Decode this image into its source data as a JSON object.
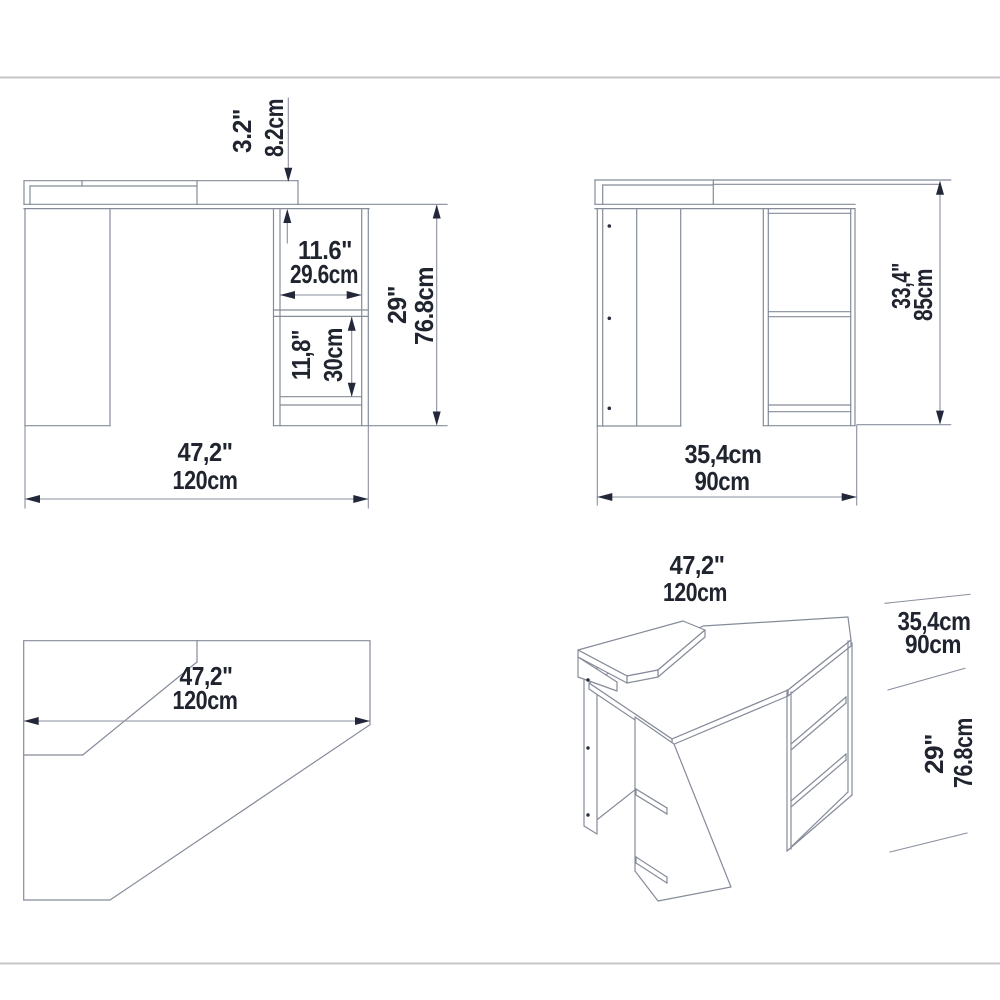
{
  "page": {
    "background": "#ffffff",
    "drawing_line_color": "#858b99",
    "dimension_text_color": "#20242f",
    "border_line_color": "#c5c5c7"
  },
  "front_view": {
    "back_rail_height": {
      "label_top": "3.2\"",
      "label_bottom": "8.2cm"
    },
    "compartment_width": {
      "label_top": "11.6\"",
      "label_bottom": "29.6cm"
    },
    "compartment_height": {
      "label_top": "11,8\"",
      "label_bottom": "30cm"
    },
    "desk_height": {
      "label_top": "29\"",
      "label_bottom": "76.8cm"
    },
    "desk_width": {
      "label_top": "47,2\"",
      "label_bottom": "120cm"
    }
  },
  "side_view": {
    "total_height": {
      "label_top": "33,4\"",
      "label_bottom": "85cm"
    },
    "desk_depth": {
      "label_top": "35,4cm",
      "label_bottom": "90cm"
    }
  },
  "top_view": {
    "desk_width": {
      "label_top": "47,2\"",
      "label_bottom": "120cm"
    }
  },
  "iso_view": {
    "desk_width": {
      "label_top": "47,2\"",
      "label_bottom": "120cm"
    },
    "desk_depth": {
      "label_top": "35,4cm",
      "label_bottom": "90cm"
    },
    "desk_height": {
      "label_top": "29\"",
      "label_bottom": "76.8cm"
    }
  }
}
